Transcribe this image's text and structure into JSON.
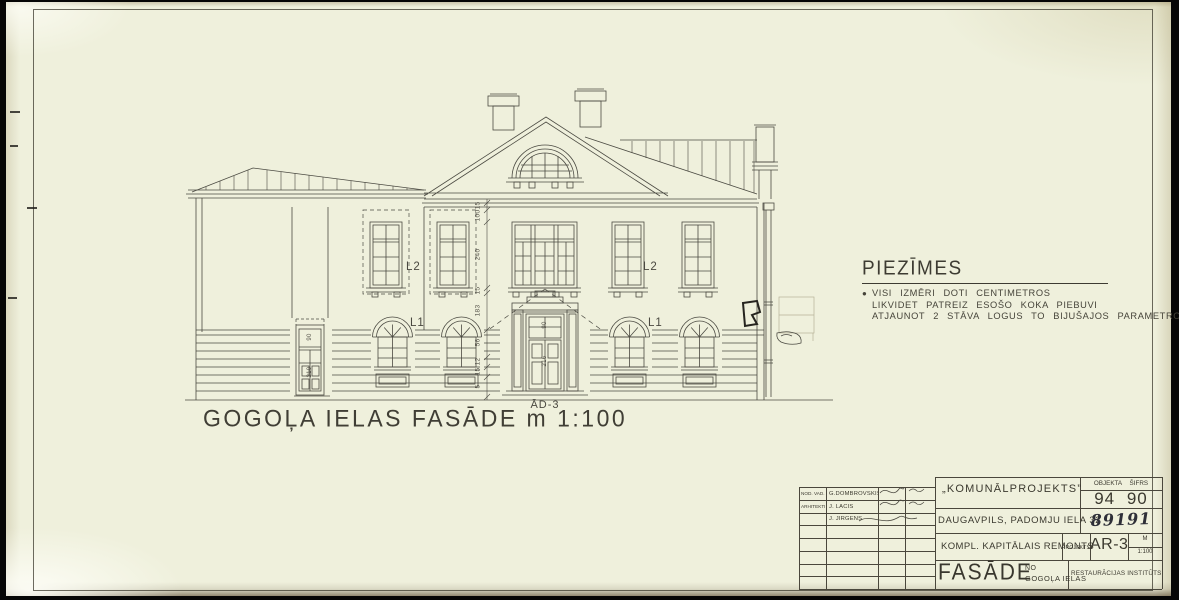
{
  "sheet": {
    "drawing_title": "GOGOĻA IELAS FASĀDE m 1:100",
    "notes": {
      "heading": "PIEZĪMES",
      "bullet": "●",
      "items": [
        "VISI IZMĒRI DOTI CENTIMETROS",
        "LIKVIDET PATREIZ ESOŠO KOKA PIEBUVI",
        "ATJAUNOT 2 STĀVA LOGUS TO BIJUŠAJOS PARAMETROS"
      ]
    },
    "labels": {
      "window_upper_left": "L2",
      "window_upper_right": "L2",
      "window_lower_left": "L1",
      "window_lower_right": "L1",
      "door_center": "ĀD-3"
    },
    "dimensions": {
      "chain": [
        "15",
        "100",
        "240",
        "15",
        "183",
        "56",
        "12",
        "15",
        "5"
      ],
      "door_center": [
        "90",
        "216"
      ],
      "door_side": [
        "90",
        "210"
      ]
    }
  },
  "titleblock": {
    "staff": [
      {
        "role": "NOD. VAD.",
        "name": "G.DOMBROVSKIS"
      },
      {
        "role": "ARHITEKTI",
        "name": "J. LĀCIS"
      },
      {
        "role": "",
        "name": "J. JIRGENS"
      }
    ],
    "organization": "„KOMUNĀLPROJEKTS”",
    "address": "DAUGAVPILS, PADOMJU IELA 32",
    "object_code_label": "OBJEKTA ŠIFRS",
    "object_code": "94 90",
    "order_number": "89191",
    "work_title": "KOMPL. KAPITĀLAIS REMONTS",
    "projekts_label": "PROJEKTS",
    "sheet_code": "AR-3",
    "scale_label": "M",
    "scale_value": "1:100",
    "drawing_name": "FASĀDE",
    "drawing_name_prefix": "NO",
    "drawing_name_street": "GOGOĻA IELAS",
    "institute": "RESTAURĀCIJAS INSTITŪTS"
  },
  "colors": {
    "paper": "#eff0dc",
    "ink": "#46443c",
    "faded_ink": "#b7b198",
    "handwriting": "#2e2f38"
  }
}
